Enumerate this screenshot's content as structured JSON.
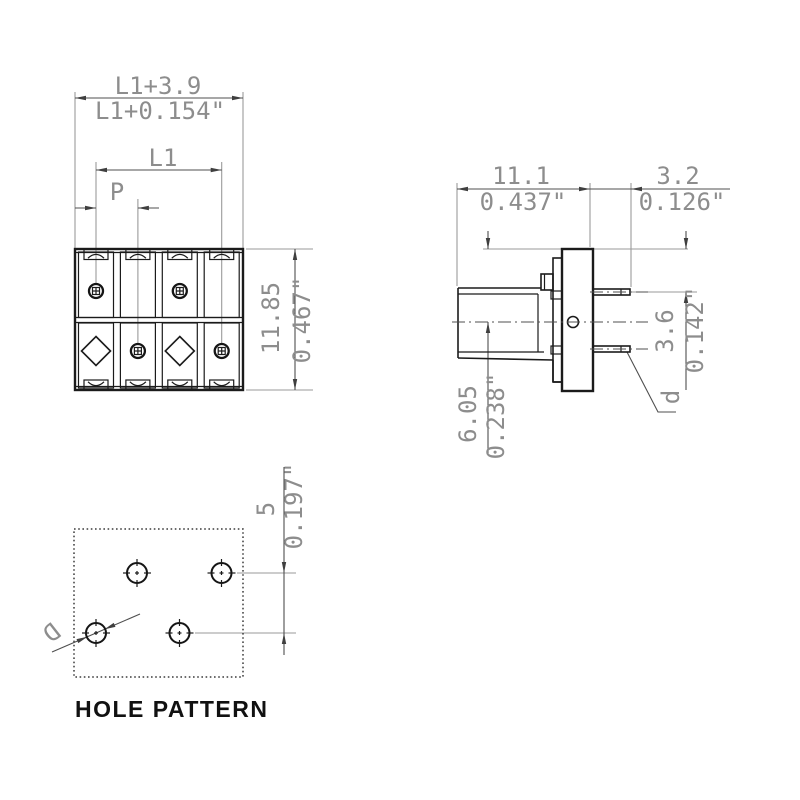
{
  "drawing": {
    "caption": "HOLE PATTERN",
    "front_view": {
      "dim_total_width_mm": "L1+3.9",
      "dim_total_width_in": "L1+0.154\"",
      "dim_pole_span": "L1",
      "dim_pitch": "P",
      "dim_height_mm": "11.85",
      "dim_height_in": "0.467\""
    },
    "side_view": {
      "dim_depth_mm": "11.1",
      "dim_depth_in": "0.437\"",
      "dim_pin_length_mm": "3.2",
      "dim_pin_length_in": "0.126\"",
      "dim_pin_offset_mm": "3.6",
      "dim_pin_offset_in": "0.142\"",
      "dim_axis_height_mm": "6.05",
      "dim_axis_height_in": "0.238\"",
      "pin_diameter_label": "d"
    },
    "hole_pattern": {
      "dim_row_spacing_mm": "5",
      "dim_row_spacing_in": "0.197\"",
      "hole_diameter_label": "D"
    }
  }
}
